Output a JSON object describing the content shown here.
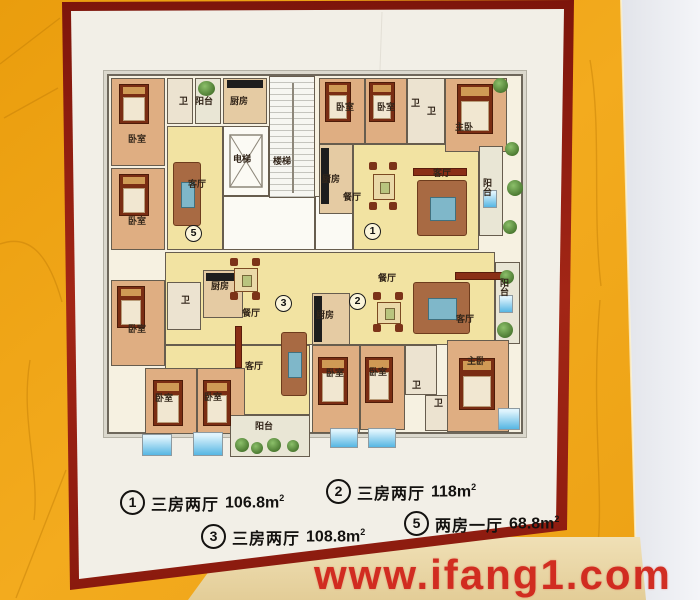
{
  "scene": {
    "watermark": "www.ifang1.com",
    "colors": {
      "wall_orange": "#efa312",
      "frame_maroon": "#8e1c0f",
      "watermark_red": "#d0241a",
      "living_yellow": "#f2e3a2",
      "bedroom_peach": "#dfae82",
      "ac_blue": "#56b6e3",
      "plant_green": "#49772f"
    }
  },
  "plan": {
    "core": {
      "elevator": "电梯",
      "stairs": "楼梯"
    },
    "unit5": {
      "num": "5",
      "bedroom1": "卧室",
      "bedroom2": "卧室",
      "bath": "卫",
      "balcony": "阳台",
      "kitchen": "厨房",
      "living": "客厅"
    },
    "unit1": {
      "num": "1",
      "bedroom1": "卧室",
      "bedroom2": "卧室",
      "bath1": "卫",
      "bath2": "卫",
      "master": "主卧",
      "kitchen": "厨房",
      "dining": "餐厅",
      "living": "客厅",
      "balcony": "阳台"
    },
    "unit3": {
      "num": "3",
      "bedroom1": "卧室",
      "bedroom2": "卧室",
      "bedroom3": "卧室",
      "bath": "卫",
      "kitchen": "厨房",
      "dining": "餐厅",
      "living": "客厅",
      "balcony": "阳台"
    },
    "unit2": {
      "num": "2",
      "dining": "餐厅",
      "kitchen": "厨房",
      "living": "客厅",
      "balcony": "阳台",
      "bedroom1": "卧室",
      "bedroom2": "卧室",
      "bath1": "卫",
      "bath2": "卫",
      "master": "主卧"
    }
  },
  "legend": {
    "items": [
      {
        "num": "1",
        "type": "三房两厅",
        "area": "106.8m",
        "sup": "2"
      },
      {
        "num": "2",
        "type": "三房两厅",
        "area": "118m",
        "sup": "2"
      },
      {
        "num": "3",
        "type": "三房两厅",
        "area": "108.8m",
        "sup": "2"
      },
      {
        "num": "5",
        "type": "两房一厅",
        "area": "68.8m",
        "sup": "2"
      }
    ]
  }
}
